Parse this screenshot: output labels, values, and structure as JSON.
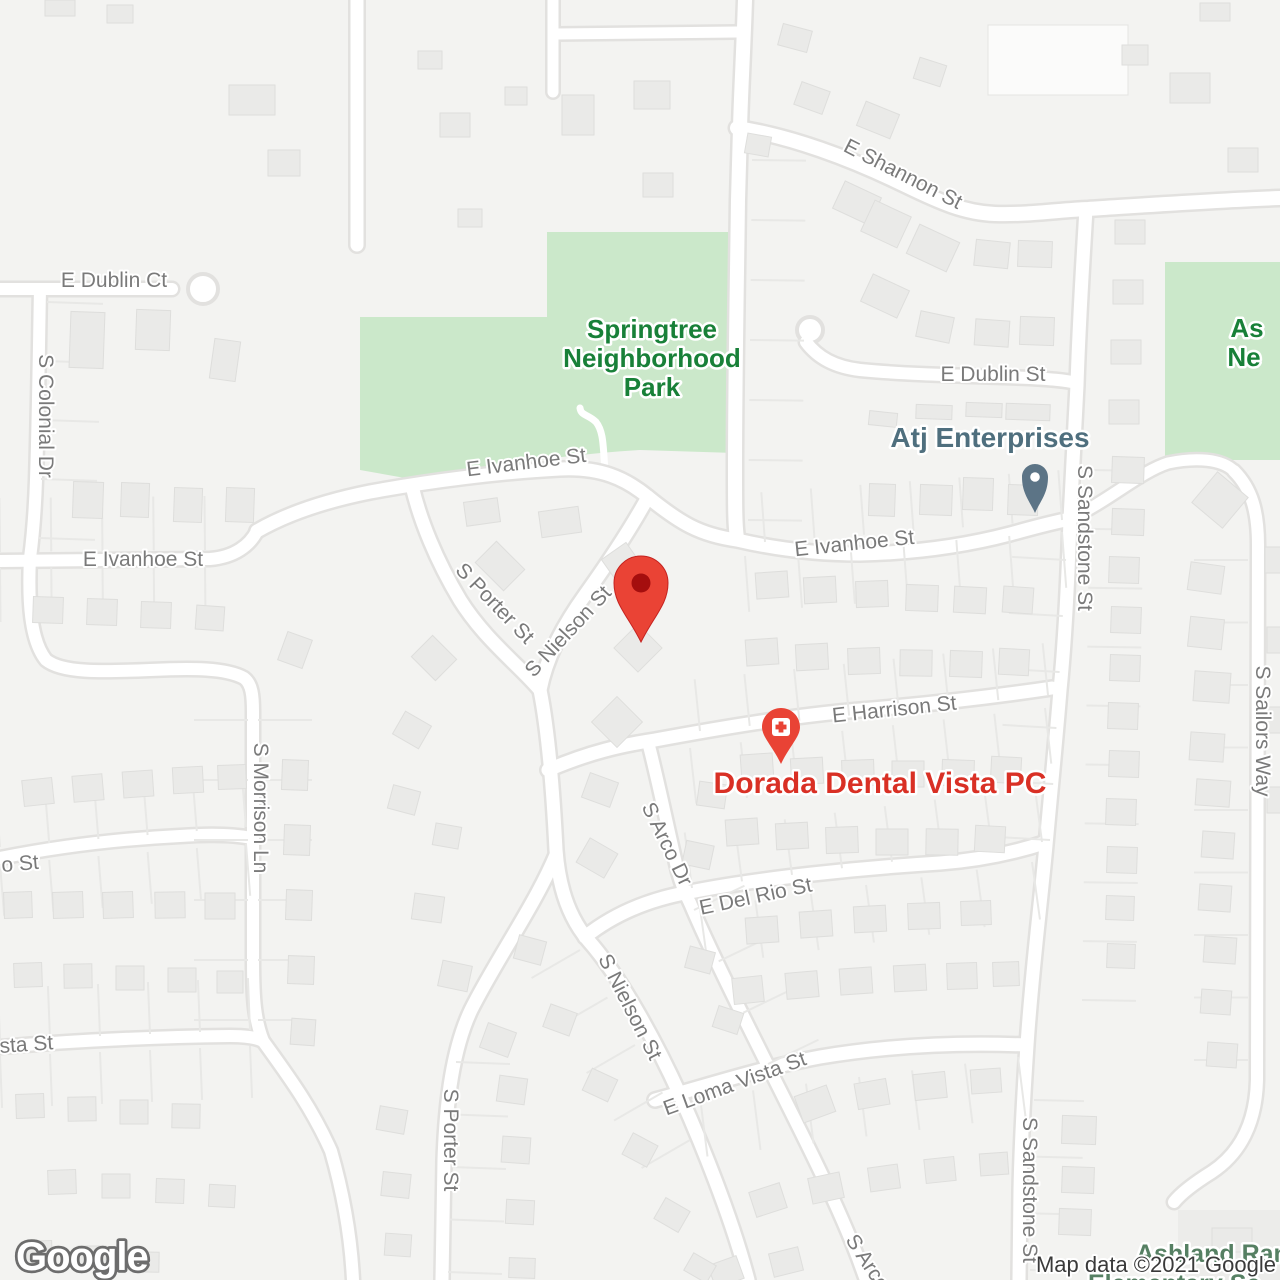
{
  "page": {
    "type": "map-view"
  },
  "colors": {
    "land": "#f3f3f1",
    "road_fill": "#ffffff",
    "road_casing": "#e2e1df",
    "building_fill": "#eaeae8",
    "building_stroke": "#dededc",
    "lot_line": "#e8e8e6",
    "park_fill": "#cbe8ca",
    "park_label": "#188038",
    "street_label": "#7a7a7a",
    "poi_teal": "#4F6F7E",
    "poi_red": "#D93025",
    "marker_red": "#EA4335",
    "marker_inner": "#A50E0E",
    "pin_teal": "#5C7486",
    "school_label": "#568063"
  },
  "streets": [
    {
      "label": "E Dublin Ct"
    },
    {
      "label": "S Colonial Dr"
    },
    {
      "label": "E Ivanhoe St"
    },
    {
      "label": "E Shannon St"
    },
    {
      "label": "E Dublin St"
    },
    {
      "label": "E Ivanhoe St"
    },
    {
      "label": "E Ivanhoe St"
    },
    {
      "label": "S Porter St"
    },
    {
      "label": "S Nielson St"
    },
    {
      "label": "S Sandstone St"
    },
    {
      "label": "S Sailors Way"
    },
    {
      "label": "E Harrison St"
    },
    {
      "label": "S Arco Dr"
    },
    {
      "label": "E Del Rio St"
    },
    {
      "label": "S Morrison Ln"
    },
    {
      "label": "o St"
    },
    {
      "label": "sta St"
    },
    {
      "label": "S Nielson St"
    },
    {
      "label": "E Loma Vista St"
    },
    {
      "label": "S Porter St"
    },
    {
      "label": "S Arco Dr"
    },
    {
      "label": "S Sandstone St"
    }
  ],
  "parks": {
    "springtree": {
      "name": "Springtree Neighborhood Park",
      "lines": [
        "Springtree",
        "Neighborhood",
        "Park"
      ]
    },
    "northeast": {
      "lines_partial": [
        "As",
        "Ne"
      ]
    }
  },
  "pois": {
    "atj": {
      "name": "Atj Enterprises"
    },
    "dorada": {
      "name": "Dorada Dental Vista PC"
    },
    "school": {
      "line1": "Ashland Ran",
      "line2": "Elementary Sc"
    }
  },
  "marker": {
    "description": "selected location pin"
  },
  "footer": {
    "logo": "Google",
    "attribution": "Map data ©2021 Google"
  }
}
